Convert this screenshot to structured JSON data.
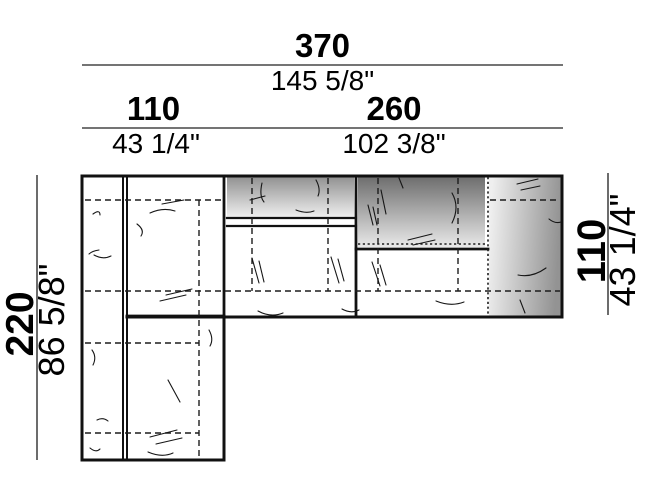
{
  "diagram": {
    "colors": {
      "background": "#ffffff",
      "outline": "#111111",
      "dimension_line": "#474747",
      "shade_dark": "#6e6e6e",
      "shade_mid": "#929292",
      "shade_light": "#f1f1f1"
    },
    "dimensions": {
      "overall_width": {
        "cm": "370",
        "inches": "145 5/8\""
      },
      "left_section_width": {
        "cm": "110",
        "inches": "43 1/4\""
      },
      "right_section_width": {
        "cm": "260",
        "inches": "102 3/8\""
      },
      "left_side_depth": {
        "cm": "220",
        "inches": "86 5/8\""
      },
      "right_side_depth": {
        "cm": "110",
        "inches": "43 1/4\""
      }
    }
  }
}
